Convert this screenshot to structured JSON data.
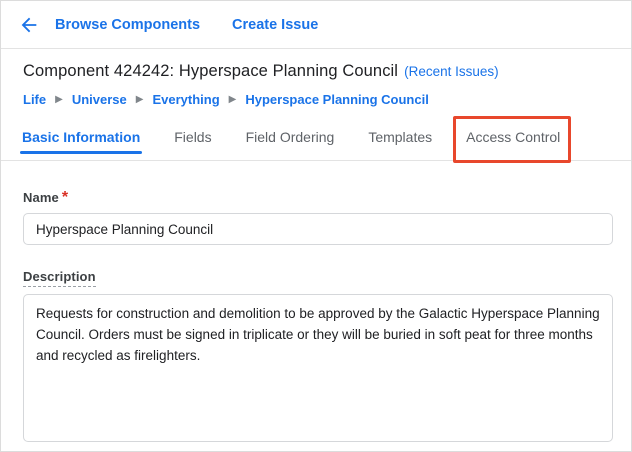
{
  "topbar": {
    "browse_components_label": "Browse Components",
    "create_issue_label": "Create Issue"
  },
  "header": {
    "title": "Component 424242: Hyperspace Planning Council",
    "recent_issues_label": "(Recent Issues)"
  },
  "breadcrumb": {
    "separator": "▶",
    "items": [
      "Life",
      "Universe",
      "Everything",
      "Hyperspace Planning Council"
    ]
  },
  "tabs": [
    {
      "label": "Basic Information",
      "active": true
    },
    {
      "label": "Fields",
      "active": false
    },
    {
      "label": "Field Ordering",
      "active": false
    },
    {
      "label": "Templates",
      "active": false
    },
    {
      "label": "Access Control",
      "active": false,
      "highlighted": true
    }
  ],
  "annotation": {
    "type": "highlight-box",
    "target": "Access Control tab",
    "color": "#e8472c"
  },
  "form": {
    "name": {
      "label": "Name",
      "required_marker": "*",
      "value": "Hyperspace Planning Council"
    },
    "description": {
      "label": "Description",
      "value": "Requests for construction and demolition to be approved by the Galactic Hyperspace Planning Council. Orders must be signed in triplicate or they will be buried in soft peat for three months and recycled as firelighters."
    }
  },
  "colors": {
    "link_blue": "#1a73e8",
    "text_dark": "#202124",
    "text_gray": "#5f6368",
    "border_gray": "#d5d7da",
    "required_red": "#d93025",
    "annotation_red": "#e8472c"
  }
}
